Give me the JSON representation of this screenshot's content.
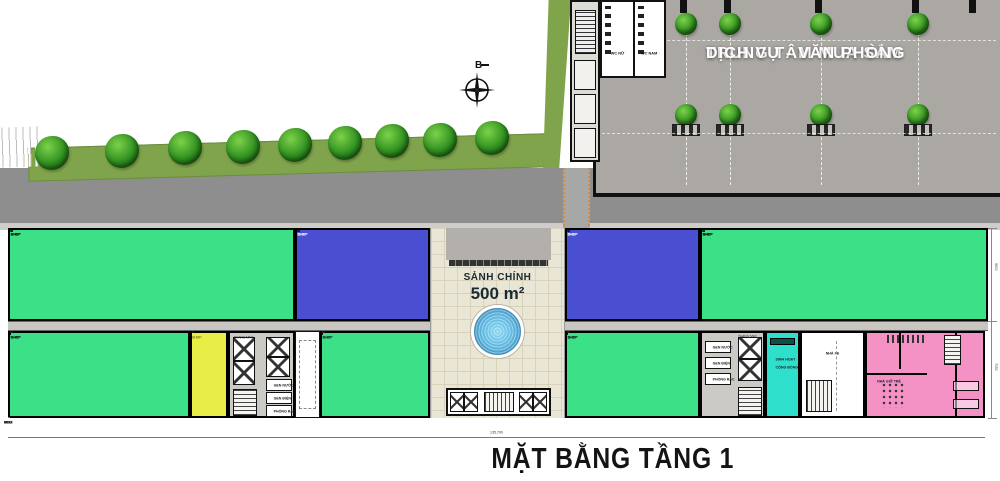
{
  "page": {
    "title": "MẶT BẰNG TẦNG 1"
  },
  "compass": {
    "north_label": "B"
  },
  "mall": {
    "title_line1": "TRUNG TÂM MUA SẮM",
    "title_line2": "DỊCH VỤ - VĂN PHÒNG",
    "wc_left": "WC NỮ",
    "wc_right": "WC NAM"
  },
  "lobby": {
    "name": "SẢNH CHÍNH",
    "area": "500 m²"
  },
  "rooms": {
    "community_line1": "SINH HOẠT",
    "community_line2": "CỘNG ĐỒNG",
    "daycare": "NHÀ GIỮ TRẺ",
    "bike": "NHÀ XE",
    "elevator": "THANG MÁY",
    "gen_water": "GEN NƯỚC",
    "gen_electric": "GEN ĐIỆN",
    "trash": "PHÒNG RÁC",
    "shop": "SHOP"
  },
  "dimensions": {
    "bottom": [
      "9550",
      "9400",
      "9400",
      "4700",
      "9400",
      "9400",
      "9500",
      "8500",
      "5800",
      "8500",
      "9500",
      "9400",
      "9400",
      "4700",
      "9400",
      "9450",
      "6000"
    ],
    "total": "135,700",
    "right": [
      "9500",
      "7050"
    ]
  },
  "site": {
    "road_trees": [
      {
        "x": 52,
        "y": 153
      },
      {
        "x": 122,
        "y": 151
      },
      {
        "x": 185,
        "y": 148
      },
      {
        "x": 243,
        "y": 147
      },
      {
        "x": 295,
        "y": 145
      },
      {
        "x": 345,
        "y": 143
      },
      {
        "x": 392,
        "y": 141
      },
      {
        "x": 440,
        "y": 140
      },
      {
        "x": 492,
        "y": 138
      }
    ],
    "mall_columns": [
      683,
      727,
      818,
      915
    ],
    "mall_stubs": [
      597,
      683,
      727,
      818,
      915,
      972
    ]
  },
  "strip": {
    "upper": [
      {
        "color": "green",
        "x": 8,
        "w": 287,
        "units": 8
      },
      {
        "color": "blue",
        "x": 295,
        "w": 135,
        "units": 4
      },
      {
        "color": "blue",
        "x": 565,
        "w": 135,
        "units": 4
      },
      {
        "color": "green",
        "x": 700,
        "w": 288,
        "units": 8
      }
    ],
    "lower": [
      {
        "color": "green",
        "x": 8,
        "w": 182,
        "units": 5
      },
      {
        "color": "yellow",
        "x": 190,
        "w": 38,
        "units": 1
      },
      {
        "color": "green",
        "x": 320,
        "w": 110,
        "units": 3
      },
      {
        "color": "green",
        "x": 565,
        "w": 135,
        "units": 4
      }
    ]
  },
  "colors": {
    "green": "#3CE086",
    "blue": "#4A4FD2",
    "yellow": "#E8EE45",
    "cyan": "#2EDFCB",
    "pink": "#F492C6",
    "road": "#8E8E8E",
    "mall_floor": "#ABA8A3",
    "grass": "#7FA44B",
    "corridor": "#C9C6C1",
    "tile": "#EAE6D6",
    "fountain": "#54B4DF"
  }
}
